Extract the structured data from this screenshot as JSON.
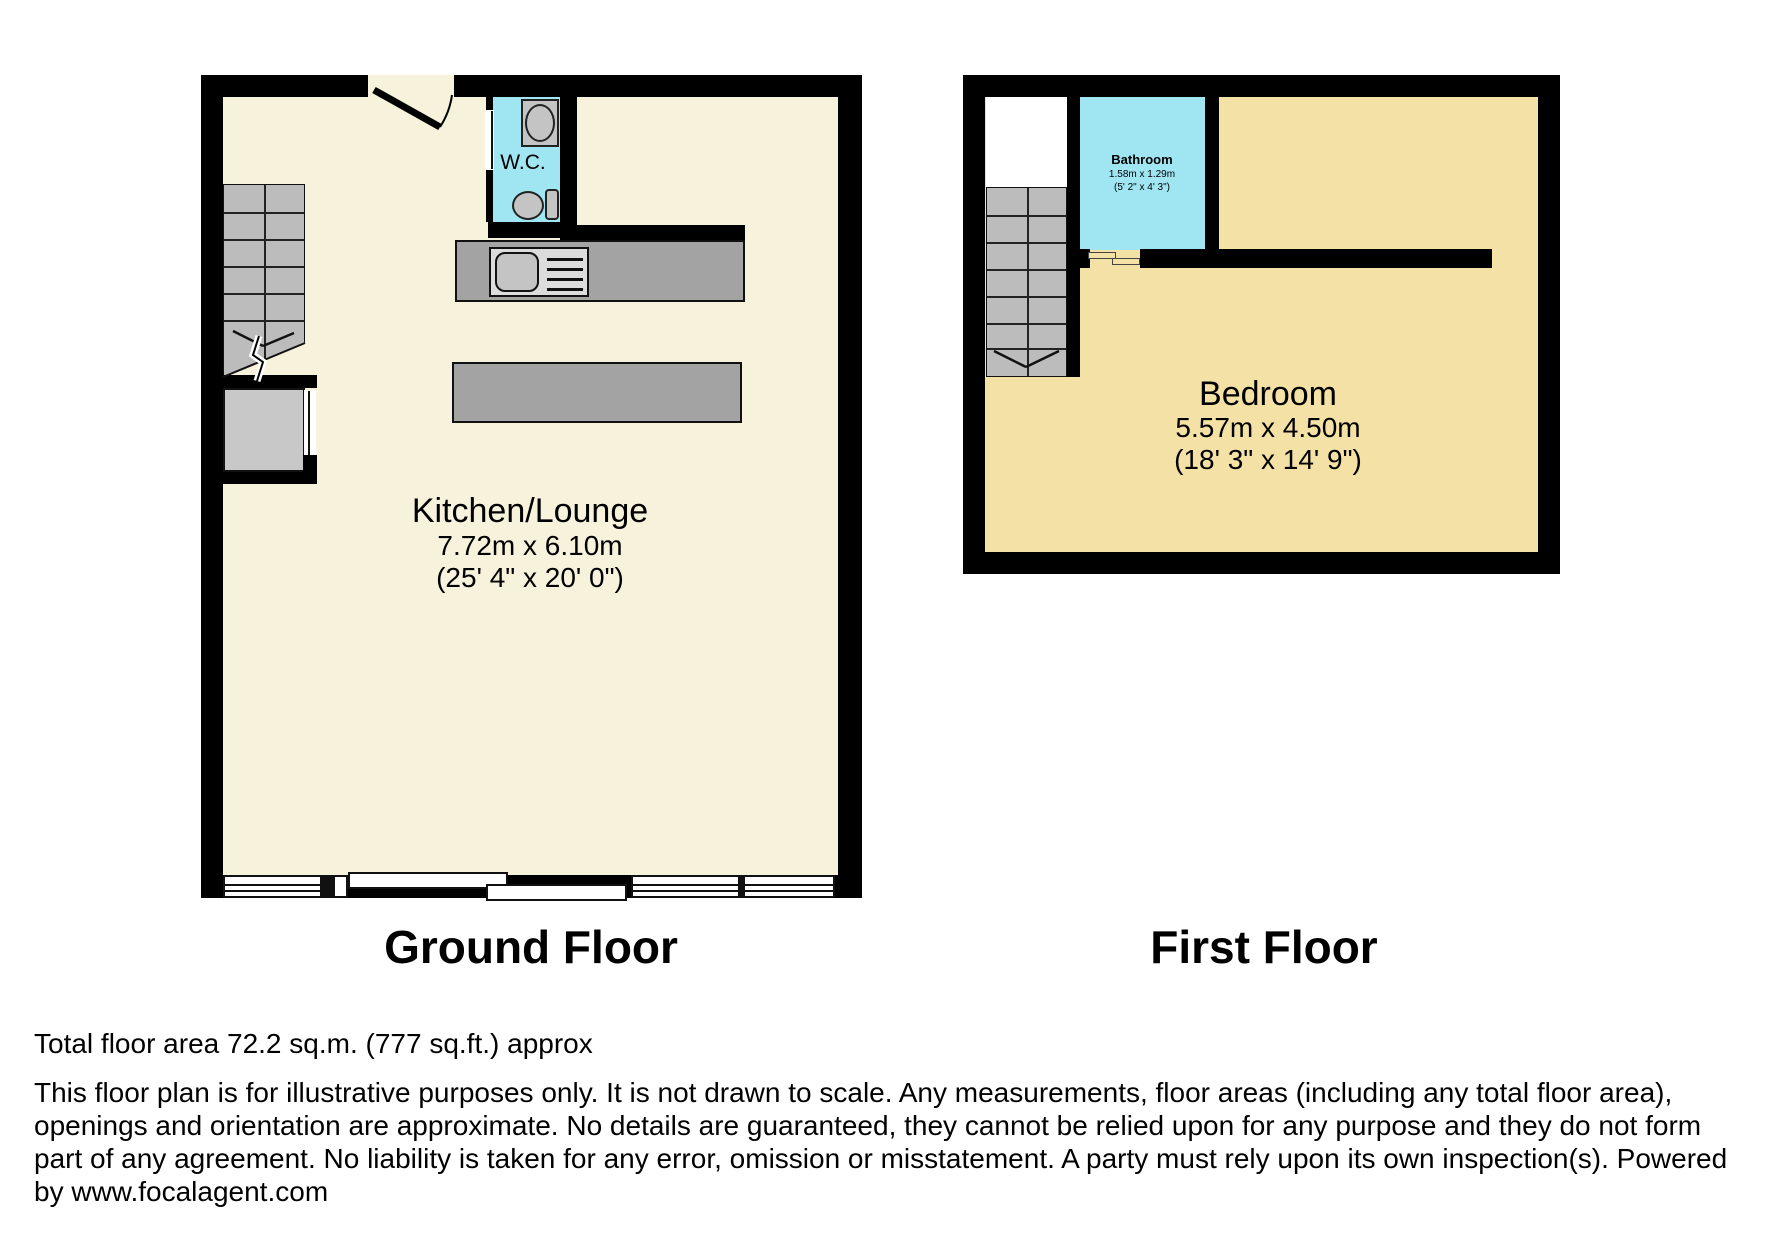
{
  "colors": {
    "wall": "#000000",
    "ground_floor_fill": "#F7F2DB",
    "first_floor_fill": "#F4E1A5",
    "wet_room_fill": "#9FE5F2",
    "counter_gray": "#A3A3A3",
    "stairs_gray": "#BCBCBC",
    "cupboard_gray": "#C8C8C8",
    "sink_light": "#DCDCDC",
    "fixture_gray": "#C4C4C4"
  },
  "ground_floor": {
    "title": "Ground Floor",
    "room_label": "Kitchen/Lounge",
    "room_dims_m": "7.72m x 6.10m",
    "room_dims_ft": "(25' 4\" x 20' 0\")",
    "wc_label": "W.C."
  },
  "first_floor": {
    "title": "First Floor",
    "bedroom_label": "Bedroom",
    "bedroom_dims_m": "5.57m x 4.50m",
    "bedroom_dims_ft": "(18' 3\" x 14' 9\")",
    "bathroom_label": "Bathroom",
    "bathroom_dims_m": "1.58m x 1.29m",
    "bathroom_dims_ft": "(5' 2\" x 4' 3\")"
  },
  "footer": {
    "total_area": "Total floor area 72.2 sq.m. (777 sq.ft.) approx",
    "disclaimer": "This floor plan is for illustrative purposes only. It is not drawn to scale. Any measurements, floor areas (including any total floor area), openings and orientation are approximate. No details are guaranteed, they cannot be relied upon for any purpose and they do not form part of any agreement. No liability is taken for any error, omission or misstatement. A party must rely upon its own inspection(s). Powered by www.focalagent.com"
  }
}
